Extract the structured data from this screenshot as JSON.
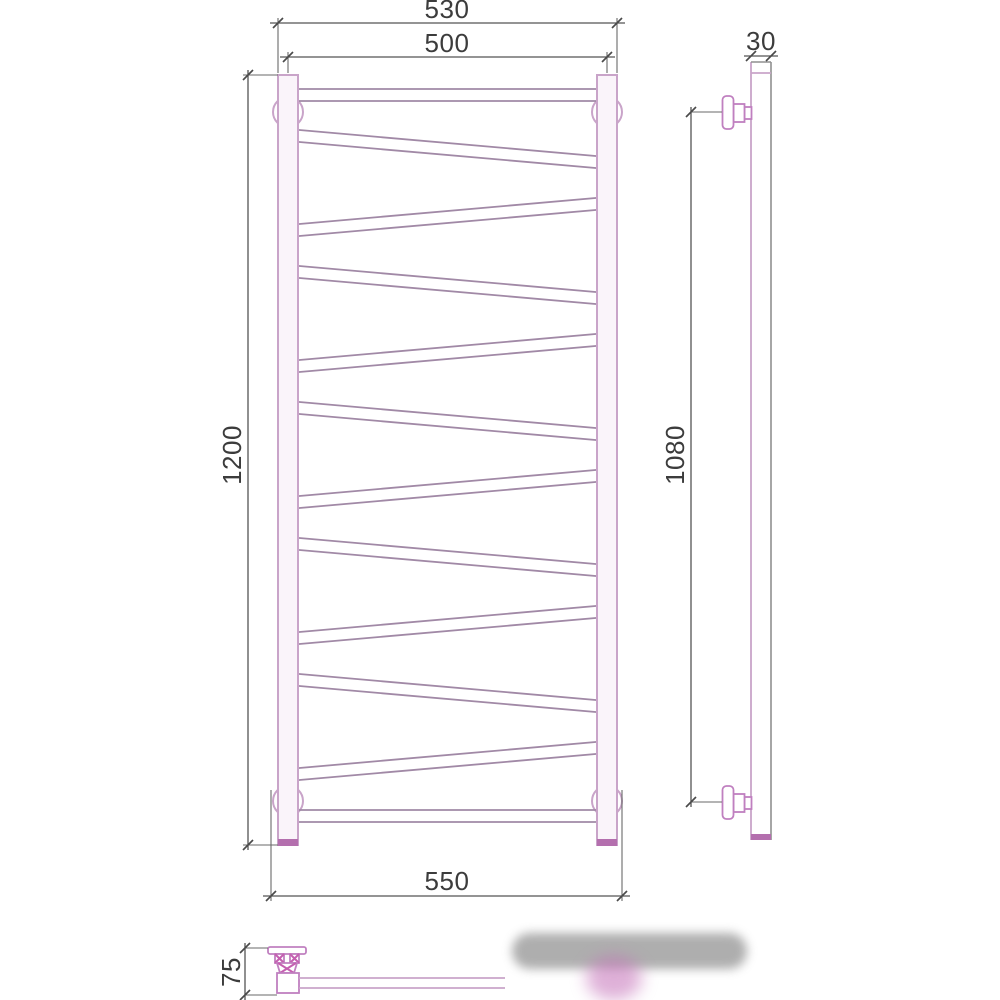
{
  "drawing": {
    "type": "technical-dimension-drawing",
    "subject": "ladder towel radiator with zigzag crossbars, front view, side view and wall-offset detail",
    "views": {
      "front": {
        "dim_top_overall": "530",
        "dim_top_centers": "500",
        "dim_height": "1200",
        "dim_bottom_overall": "550"
      },
      "side": {
        "dim_depth": "30",
        "dim_bracket_spacing": "1080"
      },
      "plan_detail": {
        "dim_wall_offset": "75"
      }
    },
    "colors": {
      "outline_pink": "#c9a4c9",
      "tube_line": "#a189a6",
      "accent_magenta": "#b46fae",
      "dimension_line": "#555555",
      "text": "#3c3c3c"
    }
  }
}
